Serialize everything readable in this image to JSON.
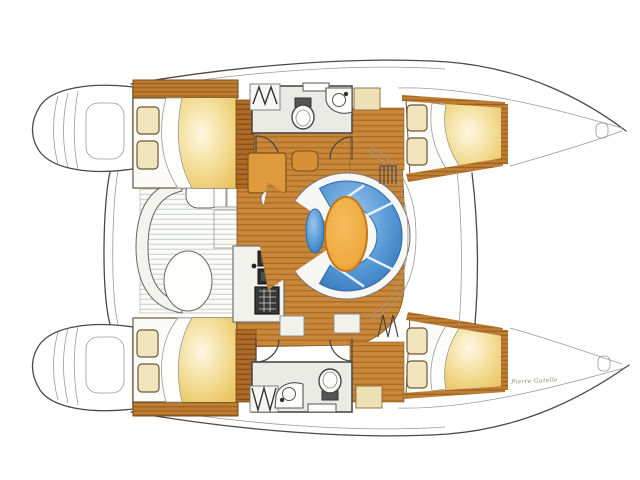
{
  "diagram": {
    "kind": "catamaran-floor-plan",
    "description": "Top-down illustrated interior layout of a 4-cabin sailing catamaran, bows to the right, twin transom platforms to the left, central saloon with curved settee and oval table"
  },
  "signature": {
    "text": "Pierre Gutelle"
  },
  "colors": {
    "outline_gray": "#4a4a4a",
    "line_light": "#9a9a9a",
    "wood_floor": "#c9873b",
    "wood_slat_line": "#a5691f",
    "headboard_wood": "#be7d33",
    "headboard_grain": "#8f5a1a",
    "sole_dark": "#b06a28",
    "bed_sheet": "#fbfbf8",
    "blanket_light": "#fdf8e3",
    "blanket_mid": "#f3dc94",
    "blanket_deep": "#e9c35e",
    "pillow": "#f2e5be",
    "pillow_outline": "#6b5836",
    "sofa_blue": "#4f93d2",
    "sofa_blue_light": "#9cc6ec",
    "sofa_blue_dark": "#2d6aad",
    "table_orange": "#efa93f",
    "table_rim": "#c07818",
    "nav_desk_orange": "#de9a3c",
    "counter_white": "#f2f2ec",
    "appliance_dark": "#383838",
    "head_floor": "#ebebe6",
    "fixture_white": "#fdfdfb",
    "locker_tan": "#ede0b5",
    "cockpit_slat": "#c9cdc9"
  },
  "parts": [
    {
      "id": "port-hull",
      "name": "Port hull (top)"
    },
    {
      "id": "starboard-hull",
      "name": "Starboard hull (bottom)"
    },
    {
      "id": "transom-platforms",
      "name": "Twin transom swim platforms with steps"
    },
    {
      "id": "cockpit",
      "name": "Aft cockpit with slatted floor and bench seats"
    },
    {
      "id": "saloon",
      "name": "Central saloon"
    },
    {
      "id": "galley",
      "name": "Galley with double sink and stove"
    },
    {
      "id": "nav-station",
      "name": "Navigation desk and seat"
    },
    {
      "id": "dinette",
      "name": "Curved blue settee with oval table and stool"
    },
    {
      "id": "port-aft-cabin",
      "name": "Aft double cabin, port"
    },
    {
      "id": "port-head",
      "name": "Head with toilet and washbasin, port"
    },
    {
      "id": "port-fore-cabin",
      "name": "Forward double cabin, port"
    },
    {
      "id": "starboard-aft-cabin",
      "name": "Aft double cabin, starboard"
    },
    {
      "id": "starboard-head",
      "name": "Head with toilet and washbasin, starboard"
    },
    {
      "id": "starboard-fore-cabin",
      "name": "Forward double cabin, starboard"
    },
    {
      "id": "foredeck",
      "name": "Foredeck crossbeam and trampoline area"
    },
    {
      "id": "bows",
      "name": "Tapered bow tips with anchor fittings"
    }
  ]
}
